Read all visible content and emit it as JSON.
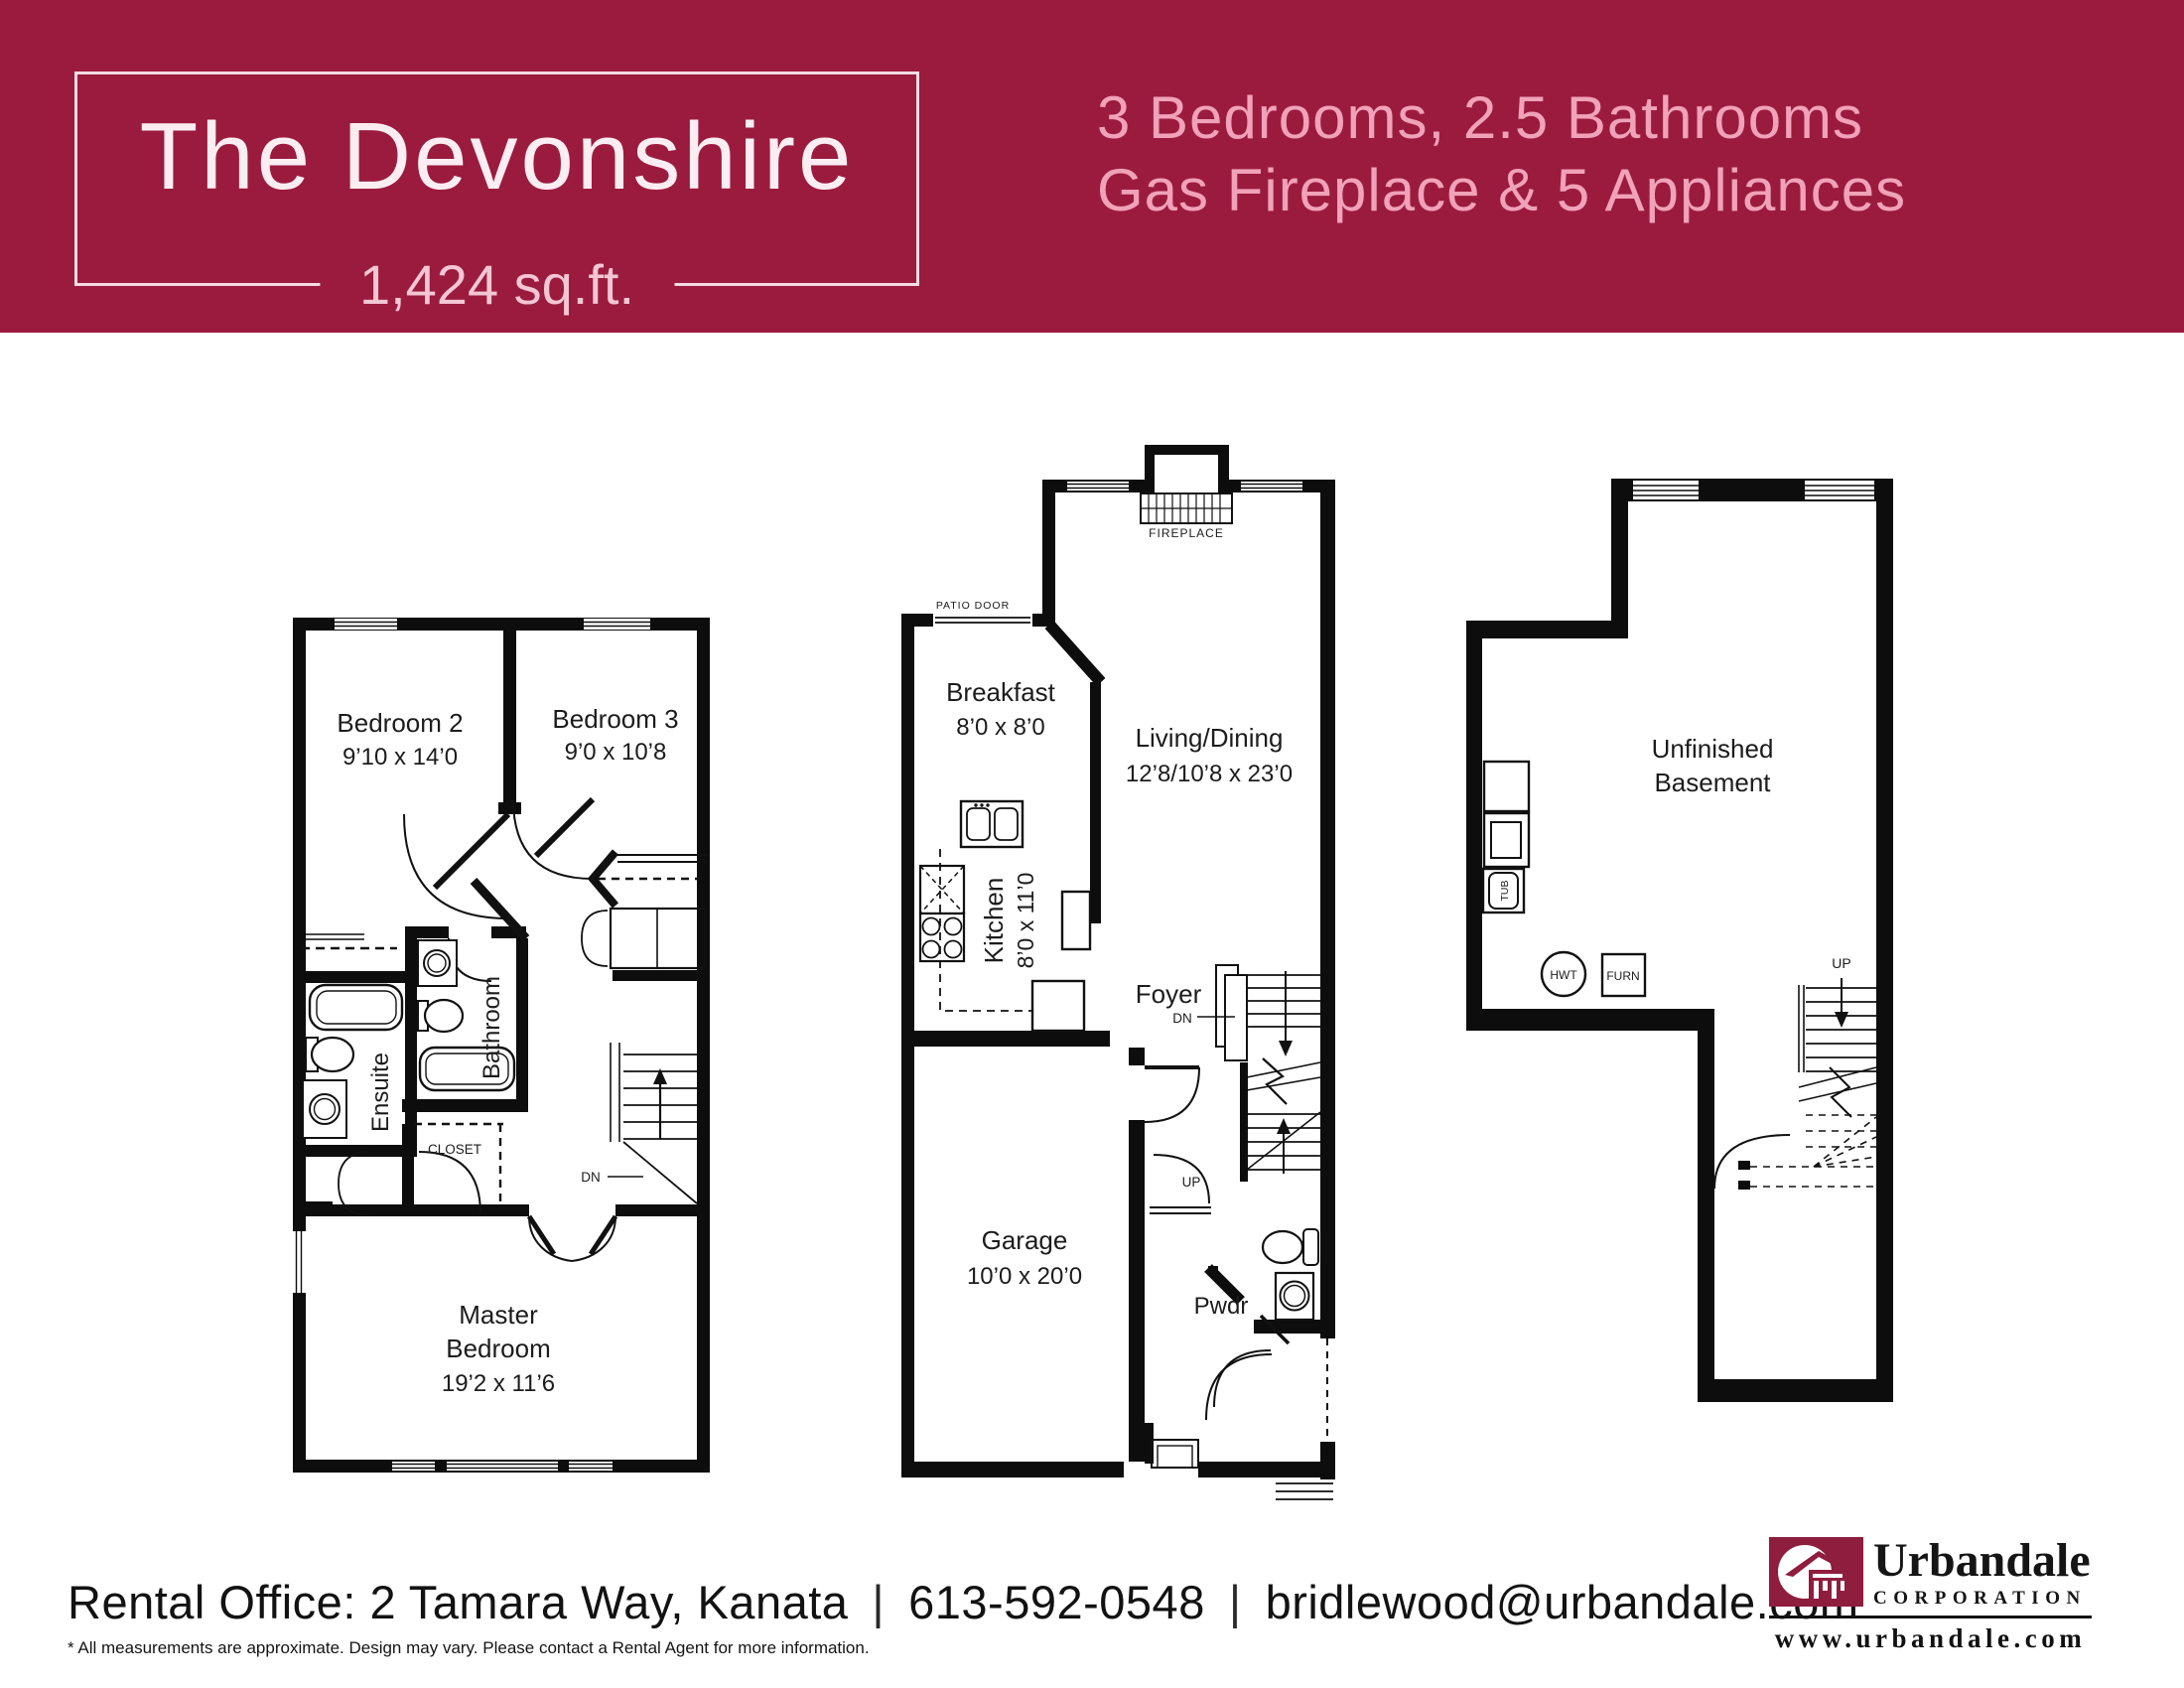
{
  "header": {
    "bg_color": "#9B1B3E",
    "title": "The Devonshire",
    "sqft": "1,424 sq.ft.",
    "features_line1": "3 Bedrooms, 2.5 Bathrooms",
    "features_line2": "Gas Fireplace & 5 Appliances"
  },
  "plans": {
    "second": {
      "bedroom2": {
        "name": "Bedroom 2",
        "dim": "9’10 x 14’0"
      },
      "bedroom3": {
        "name": "Bedroom 3",
        "dim": "9’0 x 10’8"
      },
      "bathroom": "Bathroom",
      "ensuite": "Ensuite",
      "closet": "CLOSET",
      "dn": "DN",
      "master": {
        "line1": "Master",
        "line2": "Bedroom",
        "dim": "19’2 x 11’6"
      }
    },
    "main": {
      "fireplace": "FIREPLACE",
      "patio_door": "PATIO DOOR",
      "breakfast": {
        "name": "Breakfast",
        "dim": "8’0 x 8’0"
      },
      "living": {
        "name": "Living/Dining",
        "dim": "12’8/10’8 x 23’0"
      },
      "kitchen": {
        "name": "Kitchen",
        "dim": "8’0 x 11’0"
      },
      "foyer": "Foyer",
      "dn": "DN",
      "up": "UP",
      "garage": {
        "name": "Garage",
        "dim": "10’0 x 20’0"
      },
      "pwdr": "Pwdr"
    },
    "basement": {
      "line1": "Unfinished",
      "line2": "Basement",
      "tub": "TUB",
      "hwt": "HWT",
      "furn": "FURN",
      "up": "UP"
    }
  },
  "footer": {
    "contact": "Rental Office: 2 Tamara Way, Kanata",
    "separator": "|",
    "phone": "613-592-0548",
    "email": "bridlewood@urbandale.com",
    "disclaimer": "* All measurements are approximate. Design may vary. Please contact a Rental Agent for more information.",
    "logo": {
      "name": "Urbandale",
      "subtitle": "CORPORATION",
      "website": "www.urbandale.com",
      "color": "#8E1D3E"
    }
  }
}
